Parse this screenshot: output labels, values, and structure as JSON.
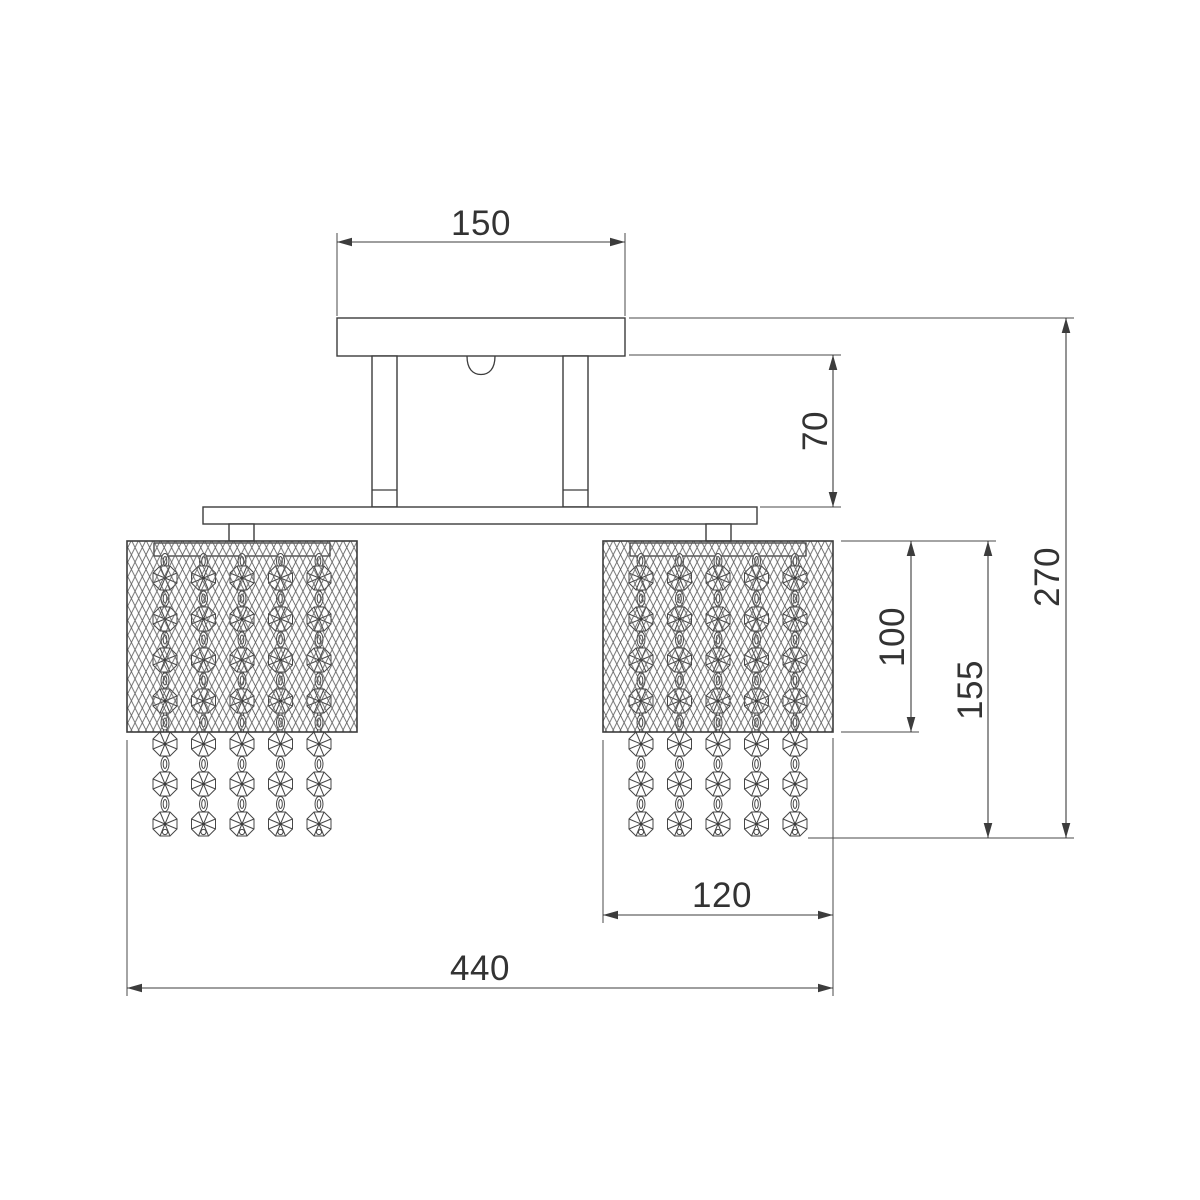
{
  "diagram": {
    "type": "technical-drawing",
    "subject": "ceiling chandelier with two crystal-strand shades, front elevation",
    "dimensions": {
      "canopy_width": "150",
      "stem_drop": "70",
      "overall_height": "270",
      "shade_body_height": "100",
      "shade_with_crystals_height": "155",
      "shade_width": "120",
      "overall_width": "440"
    },
    "colors": {
      "line": "#3c3c3c",
      "text": "#333333",
      "background": "#ffffff"
    }
  }
}
